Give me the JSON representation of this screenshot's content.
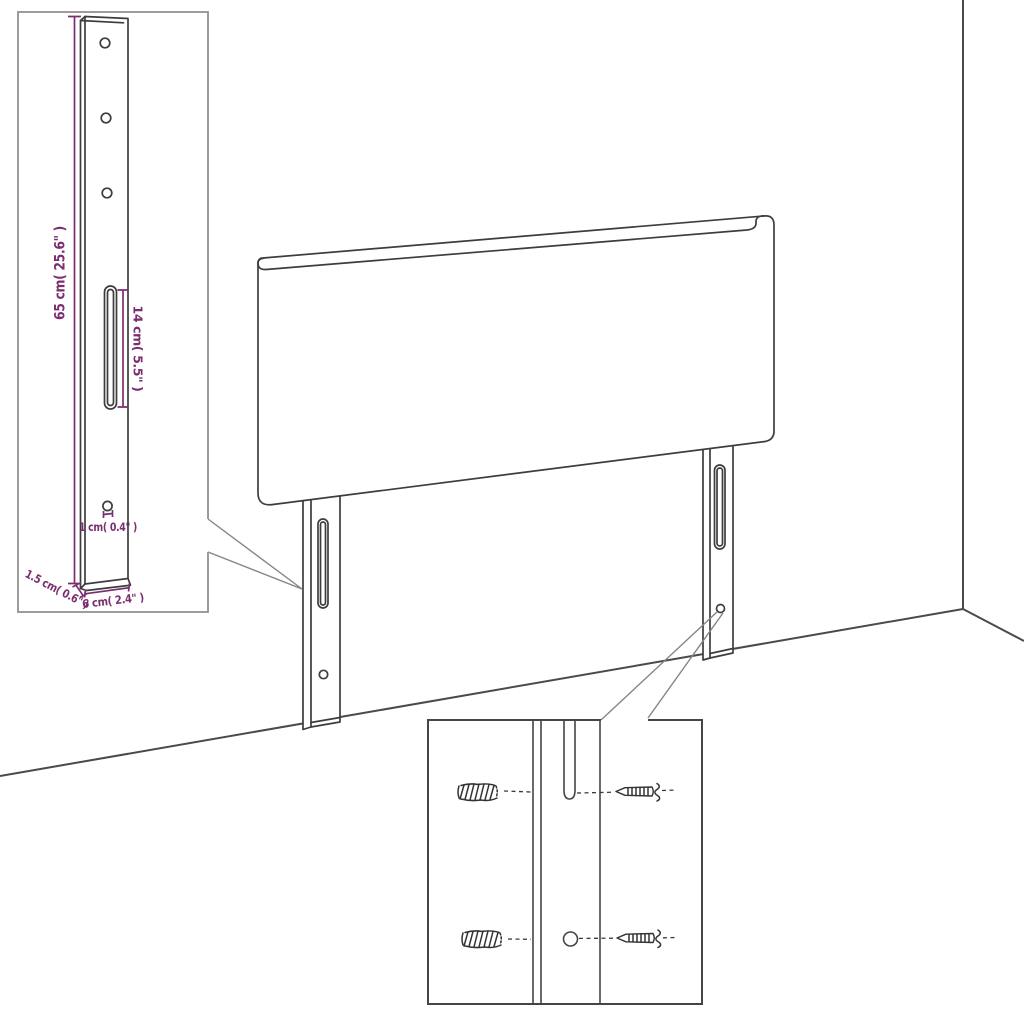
{
  "meta": {
    "figure_type": "furniture assembly dimension diagram",
    "subject": "upholstered headboard with two slotted mounting legs in room corner"
  },
  "colors": {
    "background": "#ffffff",
    "line_art": "#3d3d3d",
    "room_lines": "#4a4a4a",
    "dimension": "#7b2e6f",
    "inset_border_light": "#9c9c9c",
    "inset_border_dark": "#454545",
    "callout": "#858585"
  },
  "leg_detail_inset": {
    "dims": {
      "height": "65 cm( 25.6\" )",
      "slot_length": "14 cm( 5.5\" )",
      "hole_diameter": "1 cm( 0.4\" )",
      "thickness": "1.5 cm( 0.6\" )",
      "width": "6 cm( 2.4\" )"
    }
  },
  "mounting_detail_inset": {
    "hardware": [
      "wall-plug",
      "screw"
    ]
  }
}
